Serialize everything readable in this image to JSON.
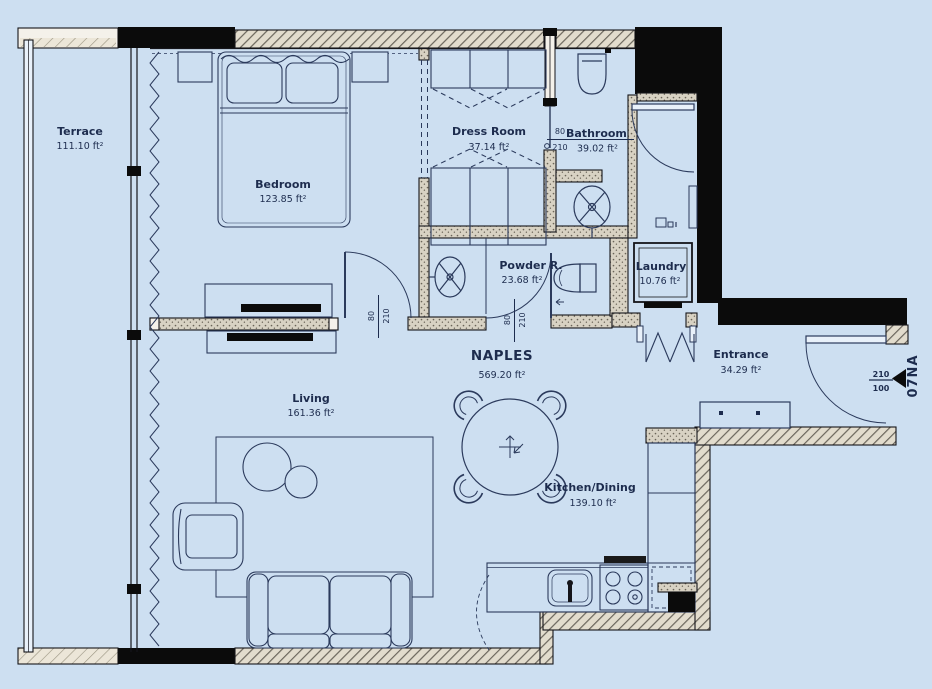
{
  "unit": {
    "name": "NAPLES",
    "area": "569.20 ft²",
    "code": "07NA"
  },
  "rooms": {
    "terrace": {
      "name": "Terrace",
      "area": "111.10 ft²"
    },
    "bedroom": {
      "name": "Bedroom",
      "area": "123.85 ft²"
    },
    "dress_room": {
      "name": "Dress Room",
      "area": "37.14 ft²"
    },
    "bathroom": {
      "name": "Bathroom",
      "area": "39.02 ft²"
    },
    "powder_room": {
      "name": "Powder R.",
      "area": "23.68 ft²"
    },
    "laundry": {
      "name": "Laundry",
      "area": "10.76 ft²"
    },
    "entrance": {
      "name": "Entrance",
      "area": "34.29 ft²"
    },
    "living": {
      "name": "Living",
      "area": "161.36 ft²"
    },
    "kitchen_dining": {
      "name": "Kitchen/Dining",
      "area": "139.10 ft²"
    }
  },
  "dims": {
    "bedroom_door": {
      "num": "80",
      "den": "210"
    },
    "powder_door": {
      "num": "80",
      "den": "210"
    },
    "bathroom_door": {
      "num": "80",
      "den": "210"
    },
    "entrance_door": {
      "num": "210",
      "den": "100"
    }
  },
  "colors": {
    "background": "#cddff1",
    "wall_black": "#0b0b0b",
    "wall_fill": "#ddd6c6",
    "line": "#2b3a5c"
  }
}
